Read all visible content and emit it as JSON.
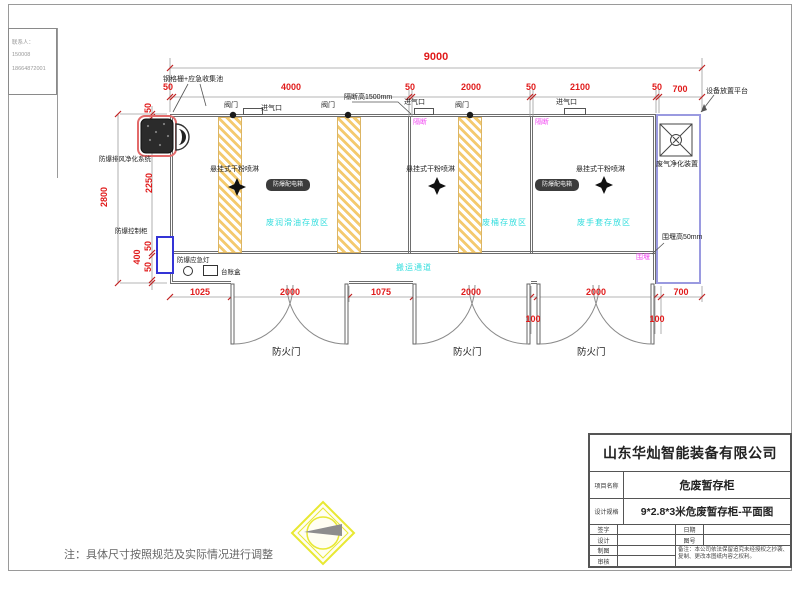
{
  "drawing": {
    "corner_note": [
      "联系人：",
      "150008",
      "18664872001"
    ],
    "grating_label": "钢格栅+应急收集池",
    "valve_label": "阀门",
    "inlet_label": "进气口",
    "partition_height_label": "隔断高1500mm",
    "partition_label": "隔断",
    "platform_label": "设备放置平台",
    "purifier_label": "废气净化装置",
    "bund_height_label": "围堰高50mm",
    "bund_label": "围堰",
    "exhaust_label": "防爆排风净化系统",
    "control_label": "防爆控制柜",
    "light_label": "防爆应急灯",
    "ledger_label": "台账盒",
    "spray_label": "悬挂式干粉喷淋",
    "badge_label": "防爆配电箱",
    "corridor_label": "搬运通道",
    "door_label": "防火门",
    "zone1": "废润滑油存放区",
    "zone2": "废桶存放区",
    "zone3": "废手套存放区",
    "note": "注：具体尺寸按照规范及实际情况进行调整"
  },
  "dims": {
    "overall_w": "9000",
    "top": [
      "50",
      "4000",
      "50",
      "2000",
      "50",
      "2100",
      "50",
      "700"
    ],
    "bottom": [
      "1025",
      "2000",
      "1075",
      "2000",
      "2000",
      "700"
    ],
    "gap1": "100",
    "gap2": "100",
    "left_overall": "2800",
    "left": [
      "50",
      "2250",
      "50",
      "400",
      "50"
    ]
  },
  "title_block": {
    "company": "山东华灿智能装备有限公司",
    "project_label": "项目名称",
    "project_value": "危废暂存柜",
    "spec_label": "设计规格",
    "spec_value": "9*2.8*3米危废暂存柜-平面图",
    "sign_label": "签字",
    "date_label": "日期",
    "design_label": "设计",
    "fig_label": "图号",
    "draft_label": "制图",
    "audit_label": "审核",
    "remark": "备注：本公司依法保留追究未经授权之抄袭、复制、更改本图纸内容之权利。"
  },
  "colors": {
    "dimension_red": "#e01b1b",
    "zone_cyan": "#35dede",
    "partition_magenta": "#f24df2",
    "hatch_yellow": "#f4ca6e",
    "control_blue": "#3434d6",
    "platform_blue": "#9a9ae0",
    "fan_red": "#e26a6a",
    "logo_yellow": "#e8e832"
  }
}
